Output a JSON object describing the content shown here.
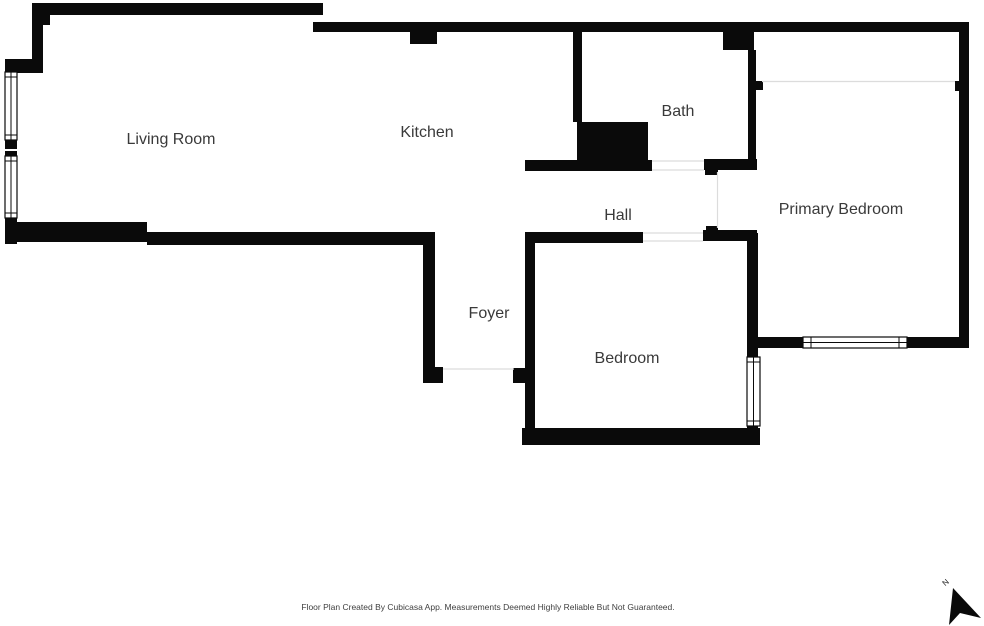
{
  "rooms": [
    {
      "label": "Living Room"
    },
    {
      "label": "Kitchen"
    },
    {
      "label": "Bath"
    },
    {
      "label": "Hall"
    },
    {
      "label": "Primary Bedroom"
    },
    {
      "label": "Foyer"
    },
    {
      "label": "Bedroom"
    }
  ],
  "footer": {
    "disclaimer": "Floor Plan Created By Cubicasa App. Measurements Deemed Highly Reliable But Not Guaranteed."
  },
  "compass": {
    "label": "N"
  },
  "colors": {
    "wall": "#0a0a0a",
    "background": "#ffffff",
    "label_text": "#3a3a3a",
    "opening_line": "#dcdcdc"
  }
}
